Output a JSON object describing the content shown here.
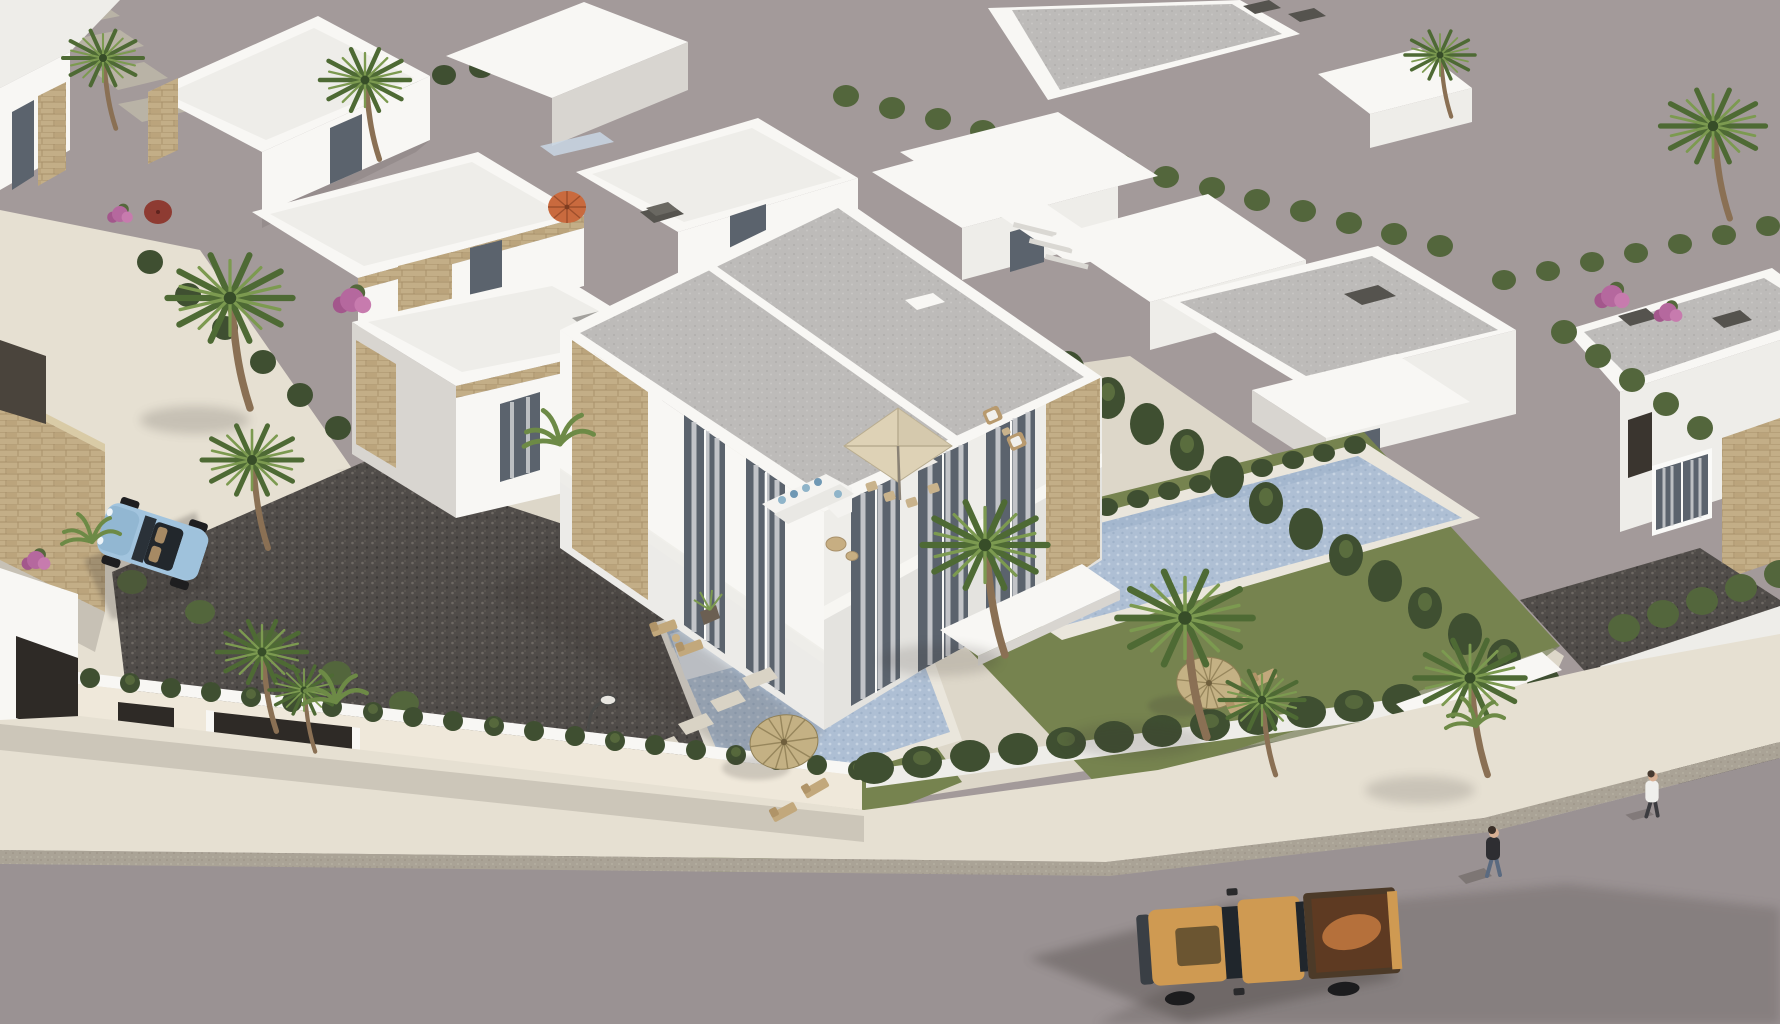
{
  "meta": {
    "title": "Aerial 3D render of a modern white villa development with pools, palm trees and a street",
    "description": "Bird's-eye architectural rendering: rows of flat-roofed white villas with stone accents, a featured semi-detached two-storey villa with terrace furniture, two mosaic-blue swimming pools, thatch and fabric parasols, palm trees, cypress hedges, perimeter walls with dark gates, a gravel yard with stepping stones, a street with an orange pickup truck, a light-blue convertible, and two pedestrians, all on a plain warm-gray backdrop.",
    "style": "3D architectural render",
    "view": "aerial three-quarter",
    "lighting": "afternoon sun from upper right; soft shadows fall to lower left"
  },
  "palette": {
    "backdrop": "#a39a9a",
    "road": "#9a9293",
    "curb": "#aaa396",
    "sidewalk": "#e6e0d2",
    "plaza": "#d8d1c2",
    "terrace": "#ddd7c9",
    "wall_white": "#f8f7f4",
    "wall_face": "#eeede9",
    "wall_shade": "#d8d5d0",
    "wall_cream": "#efe8da",
    "roof_gray": "#bdbbb9",
    "roof_cap": "#55534e",
    "stone": "#c3ae87",
    "stone_line": "#a8916b",
    "hedge_dark": "#3f4f31",
    "hedge_mid": "#53663c",
    "hedge_light": "#6d8248",
    "lawn": "#76834f",
    "lawn_shade": "#5e6b41",
    "gravel": "#504c49",
    "pool": "#aebfd4",
    "pool_light": "#c9d6e4",
    "pool_steps": "#dfe5ec",
    "coping": "#eae6dc",
    "thatch": "#c4b184",
    "thatch_line": "#97865c",
    "umbrella_cream": "#ded2b6",
    "umbrella_orange": "#c96a3e",
    "umbrella_red": "#8e3b32",
    "truck_body": "#cf9a52",
    "truck_hood": "#6b5531",
    "truck_bed": "#5e3a22",
    "truck_copper": "#c47a3f",
    "window_glass": "#5b636d",
    "glass_dark": "#20262c",
    "car_blue": "#a2c4de",
    "car_dark": "#4a5258",
    "car_red": "#a33a2e",
    "gate_dark": "#2e2a26",
    "garage_brown": "#352c21",
    "trunk": "#8a7054",
    "palm_dark": "#4e6a34",
    "palm_light": "#7c9a50",
    "flower_pink": "#b5689e",
    "curtain": "#d5d6d8",
    "shadow": "#3b3530",
    "skin": "#d8b094",
    "person_dark": "#2e2e32",
    "person_jeans": "#5a6a80",
    "person_white": "#efefec"
  },
  "scene": {
    "background": "plain warm-gray studio backdrop visible at upper right",
    "objects": [
      {
        "name": "featured-villa",
        "label": "two-storey semi-detached white villa with gray flat roof, stone cladding and curtained floor-to-ceiling windows"
      },
      {
        "name": "left-annex",
        "label": "single-storey wing with stone coping"
      },
      {
        "name": "left-pool",
        "label": "mosaic-blue pool of the left unit"
      },
      {
        "name": "right-pool",
        "label": "long mosaic-blue pool of the right unit"
      },
      {
        "name": "gravel-yard",
        "label": "dark gravel yard with stepping stones and street lamp"
      },
      {
        "name": "terrace",
        "label": "travertine terrace with L-sofa, dining set and cream umbrella"
      },
      {
        "name": "thatch-parasol-left",
        "label": "straw parasol with deck chairs on lawn"
      },
      {
        "name": "thatch-parasol-right",
        "label": "straw parasol beside right pool"
      },
      {
        "name": "orange-parasol",
        "label": "orange parasol in neighbour garden"
      },
      {
        "name": "red-parasol",
        "label": "dark-red parasol in far garden"
      },
      {
        "name": "pickup-truck",
        "label": "orange double-cab pickup truck on the street"
      },
      {
        "name": "blue-convertible",
        "label": "light-blue convertible parked on the side street"
      },
      {
        "name": "red-car",
        "label": "red car glimpsed behind a hedge"
      },
      {
        "name": "dark-car",
        "label": "dark car behind the entrance hedge"
      },
      {
        "name": "pedestrian-dark",
        "label": "walker in dark top and jeans on the road"
      },
      {
        "name": "pedestrian-white",
        "label": "walker in white shirt at the entrance"
      },
      {
        "name": "perimeter-wall",
        "label": "white boundary wall with dark gates and hedge on top"
      },
      {
        "name": "entrance-garage",
        "label": "corner entrance with dark brown garage door"
      },
      {
        "name": "background-villas",
        "label": "rows of flat-roofed white villas with stone accents"
      },
      {
        "name": "palm-trees",
        "label": "fan palms scattered through the gardens"
      },
      {
        "name": "bougainvillea",
        "label": "pink bougainvillea shrubs"
      },
      {
        "name": "street",
        "label": "asphalt road with curb and cream sidewalk"
      }
    ],
    "counts": {
      "background_villas": 12,
      "palm_trees": 12,
      "swimming_pools": 2,
      "thatch_parasols": 2,
      "fabric_parasols": 3,
      "vehicles": 4,
      "people": 2,
      "gates": 3
    }
  }
}
